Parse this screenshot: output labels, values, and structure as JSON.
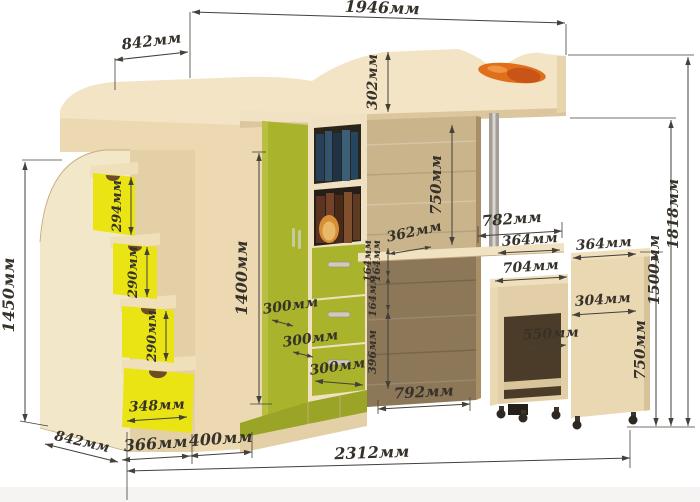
{
  "diagram": {
    "unit": "мм",
    "labels": {
      "top_width": "1946мм",
      "top_left_width": "842мм",
      "rail_height": "302мм",
      "underbed_height": "750мм",
      "wardrobe_height": "1400мм",
      "step1_height": "294мм",
      "step2_height": "290мм",
      "step3_height": "290мм",
      "stairs_height": "1450мм",
      "bottom_drawer_width": "348мм",
      "stairs_depth": "842мм",
      "base_width_1": "366мм",
      "base_width_2": "400мм",
      "total_width": "2312мм",
      "corner_depth_1": "300мм",
      "corner_depth_2": "300мм",
      "corner_depth_3": "300мм",
      "desk_inset": "362мм",
      "drawer1_height": "164мм",
      "drawer2_height": "164мм",
      "drawer3_height": "164мм",
      "lower_section_height": "396мм",
      "niche_width": "792мм",
      "desk_width": "782мм",
      "desk_depth_1": "364мм",
      "cart_top_depth": "364мм",
      "desk_inner_width": "704мм",
      "cart_width": "304мм",
      "knee_space": "550мм",
      "cart_height": "750мм",
      "bed_platform_height": "1500мм",
      "total_height": "1818мм"
    },
    "colors": {
      "background": "#ffffff",
      "wood_light": "#f2e4c4",
      "wood_wall": "#ecd9b2",
      "panel_upper": "#c9b48c",
      "panel_lower": "#8d7759",
      "accent_yellow": "#eae414",
      "accent_green": "#a9b42c",
      "accent_orange": "#df6f1b",
      "metal_pole": "#a39e97",
      "dimension_line": "#44403a",
      "dimension_text": "#36322a"
    }
  }
}
